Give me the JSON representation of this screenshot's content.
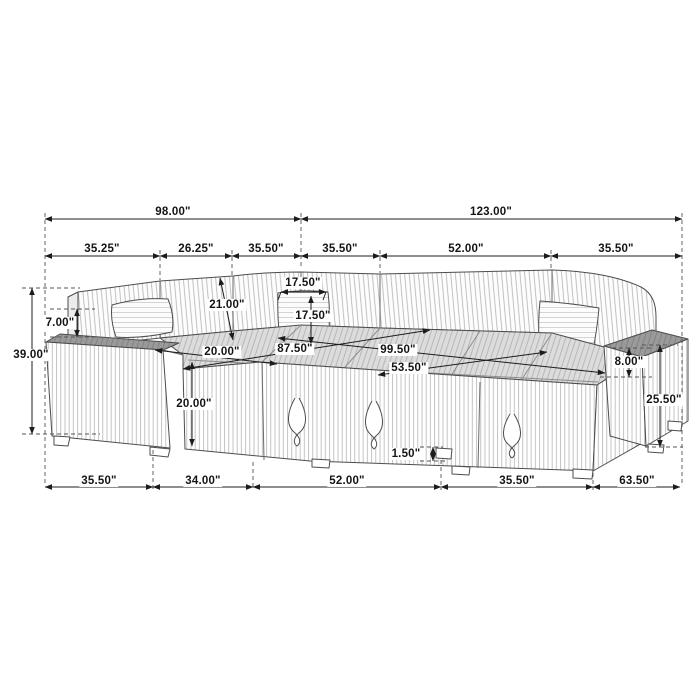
{
  "unit": "inches",
  "illustration": "u-shaped-sectional-sleeper-sofa-line-drawing",
  "dims": {
    "top": {
      "left_total": "98.00\"",
      "right_total": "123.00\"",
      "left_segments": [
        "35.25\"",
        "26.25\"",
        "35.50\""
      ],
      "right_segments": [
        "35.50\"",
        "52.00\"",
        "35.50\""
      ]
    },
    "bottom_segments": [
      "35.50\"",
      "34.00\"",
      "52.00\"",
      "35.50\"",
      "63.50\""
    ],
    "left": {
      "overall_height": "39.00\"",
      "back_above_arm": "7.00\"",
      "back_cushion_height": "21.00\"",
      "seat_depth": "20.00\"",
      "seat_height": "20.00\""
    },
    "middle": {
      "pillow_width": "17.50\"",
      "pillow_height": "17.50\"",
      "left_chaise_depth": "87.50\"",
      "right_section_depth": "99.50\"",
      "bed_width": "53.50\"",
      "leg_height": "1.50\""
    },
    "right": {
      "arm_above_seat": "8.00\"",
      "arm_height": "25.50\""
    }
  }
}
